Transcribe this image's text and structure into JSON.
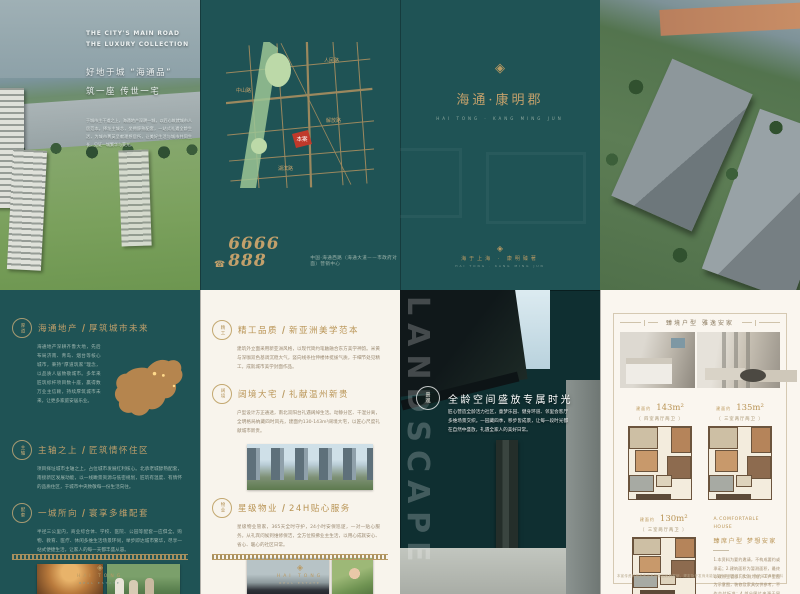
{
  "colors": {
    "teal": "#1f5355",
    "gold": "#c2a06b",
    "cream": "#f8f4ec",
    "accentRed": "#c0392b"
  },
  "brand": {
    "logo_glyph": "◈",
    "logo_text": "HAI TONG",
    "logo_sub": "REAL ESTATE",
    "sig_zh": "海于上海 · 康明臻著",
    "sig_en": "HAI TONG · KANG MING JUN"
  },
  "topLeft": {
    "en1": "THE CITY'S MAIN ROAD",
    "en2": "THE LUXURY COLLECTION",
    "zh1": "好地于城 “海通品”",
    "zh2": "筑一座 传世一宅",
    "para": "于城市主干道之上，海通地产深耕一城，以匠心筑就城市人居范本。择址主城芯，坐拥醇熟配套，一站式礼遇全龄生活，为城市菁英呈献理想居所，让美好生活与城市共同生长，见证一城繁华与荣光。"
  },
  "topMid": {
    "phone_icon": "☎",
    "phone": "6666 888",
    "address": "中国·海通西路（海通大道——市政府对面）营销中心",
    "marker": "本案",
    "roads": [
      "人民路",
      "中山路",
      "解放路",
      "湖滨路"
    ]
  },
  "topRight": {
    "seal_glyph": "◈",
    "title": "海通·康明郡",
    "subtitle": "HAI TONG · KANG MING JUN"
  },
  "bottomLeft": {
    "sections": [
      {
        "seal": "厚道",
        "h1": "海通地产",
        "h2": "厚筑城市未来",
        "para": "海通地产深耕齐鲁大地，先后布局济南、青岛、烟台等核心城市，秉持“厚道筑家”理念，以品质人居致敬城市。多年来匠筑标杆项目数十座，赢得数万业主信赖，持续厚筑城市未来，让更多家庭安居乐业。"
      },
      {
        "seal": "主轴",
        "h1": "主轴之上",
        "h2": "匠筑情怀住区",
        "para": "项目择址城市主轴之上，占位城市发展红利核心。北承老城醇熟配套，南接新区发展动能，以一线瞰景资源与低密规划，匠筑有温度、有情怀的品质住区，于城市中央致敬每一份生活向往。"
      },
      {
        "seal": "配套",
        "h1": "一城所向",
        "h2": "寰享多维配套",
        "para": "半径三公里内，商业综合体、学校、医院、公园等配套一应俱全。购物、教育、医疗、休闲多维生活场景环伺，举步即达城市繁华，尽享一站式便捷生活，让家人的每一天都丰盛从容。"
      }
    ]
  },
  "bottomMid": {
    "sections": [
      {
        "seal": "精工",
        "h1": "精工品质",
        "h2": "新亚洲美学范本",
        "para": "建筑外立面采用新亚洲风格，以现代简约笔触融合东方美学神韵。米黄与深咖双色基调沉稳大气，竖向线条拉伸楼体挺拔气质，于细节处见精工，成就城市美学封面作品。"
      },
      {
        "seal": "阔境",
        "h1": "阔境大宅",
        "h2": "礼献温州新贵",
        "para": "户型设计方正通透，南北双阳台礼遇阔绰生活。动静分区、干湿分离，全明格局纳藏四时风光，建面约130-143m²阔境大宅，以匠心尺度礼献城市新贵。"
      },
      {
        "seal": "物业",
        "h1": "星级物业",
        "h2": "24H贴心服务",
        "para": "星级物业管家，365天全时守护，24小时安保巡逻，一对一贴心服务。从礼宾问候到维修保洁，全方位照拂业主生活，以用心成就安心、省心、暖心的社区日常。"
      }
    ]
  },
  "bottomPhoto": {
    "vertical_text": "LANDSCAPE",
    "seal": "景观",
    "h1": "全龄空间",
    "h2": "盛放专属时光",
    "para": "匠心营造全龄活力社区，童梦乐园、健身环道、邻里会客厅多维场景交织。一园藏四季，移步皆成景，让每一段时光都在自然中盛放，礼遇全家人的美好日常。"
  },
  "bottomRight": {
    "header": "臻境户型 雅逸安家",
    "plans": [
      {
        "pre": "建面约",
        "num": "143m²",
        "tag": "〔 四室两厅两卫 〕"
      },
      {
        "pre": "建面约",
        "num": "135m²",
        "tag": "〔 三室两厅两卫 〕"
      },
      {
        "pre": "建面约",
        "num": "130m²",
        "tag": "〔 三室两厅两卫 〕"
      }
    ],
    "hblock_en": "A.COMFORTABLE HOUSE",
    "hblock_zh": "臻席户型 梦想安家",
    "bullets": "1.本资料为要约邀请，不构成要约或承诺；2.建筑面积为暂测面积，最终以政府主管部门实测为准；3.户型图为示意图，装修及家具仅供参考，不作交付标准；4.部分图片来源于网络，如有侵权请联系删除。",
    "disclaimer": "本宣传资料相关内容不排除因政府规划、规定及开发商未能控制的原因而发生变化，敬请留意最新资料"
  }
}
